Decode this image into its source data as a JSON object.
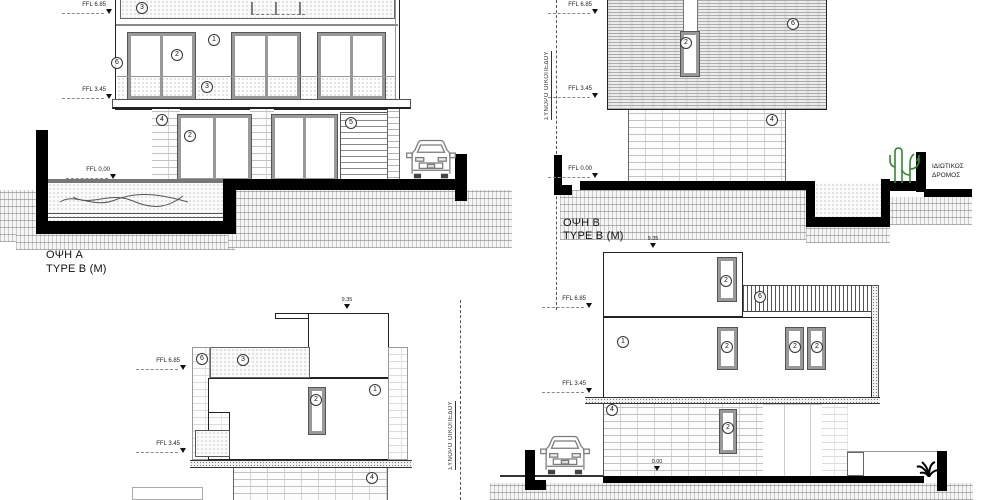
{
  "drawings": {
    "elevation_a": {
      "title": "ΟΨΗ A",
      "subtitle": "TYPE B (M)"
    },
    "elevation_b": {
      "title": "ΟΨΗ B",
      "subtitle": "TYPE B (M)"
    }
  },
  "levels": {
    "ffl_685": "FFL 6.85",
    "ffl_345": "FFL 3.45",
    "ffl_000": "FFL 0.00",
    "zero": "0.00",
    "parapet": "9.35"
  },
  "annotations": {
    "boundary": "ΣΥΝΟΡΟ ΟΙΚΟΠΕΔΟΥ",
    "road_line1": "ΙΔΙΩΤΙΚΟΣ",
    "road_line2": "ΔΡΟΜΟΣ"
  },
  "keynotes": {
    "k1": "1",
    "k2": "2",
    "k3": "3",
    "k4": "4",
    "k5": "5",
    "k6": "6"
  },
  "colors": {
    "ink": "#333333",
    "frame": "#999999",
    "solid": "#000000",
    "green": "#2e8b2e"
  }
}
